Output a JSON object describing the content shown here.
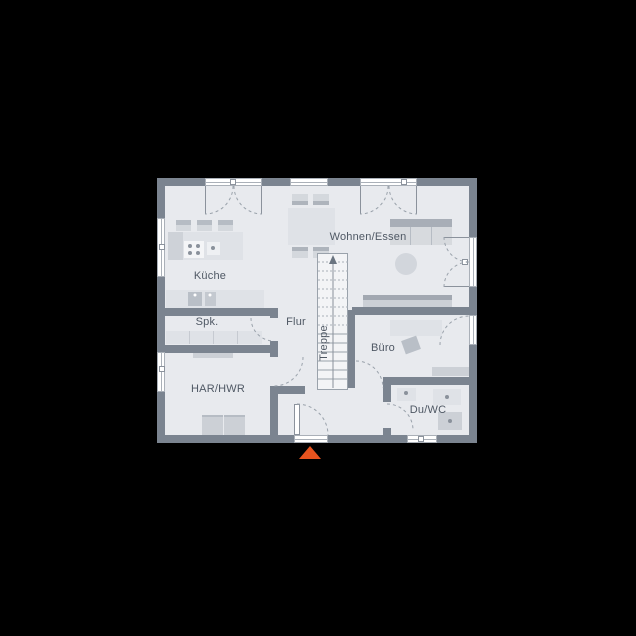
{
  "plan": {
    "rooms": [
      {
        "label": "Küche"
      },
      {
        "label": "Wohnen/Essen"
      },
      {
        "label": "Spk."
      },
      {
        "label": "Flur"
      },
      {
        "label": "Treppe"
      },
      {
        "label": "Büro"
      },
      {
        "label": "HAR/HWR"
      },
      {
        "label": "Du/WC"
      }
    ],
    "colors": {
      "background": "#000000",
      "wall": "#7b8490",
      "floor": "#e8eaee",
      "accent": "#e8531e"
    },
    "entrance_marker": {
      "shape": "triangle-up",
      "color": "#e8531e"
    }
  }
}
